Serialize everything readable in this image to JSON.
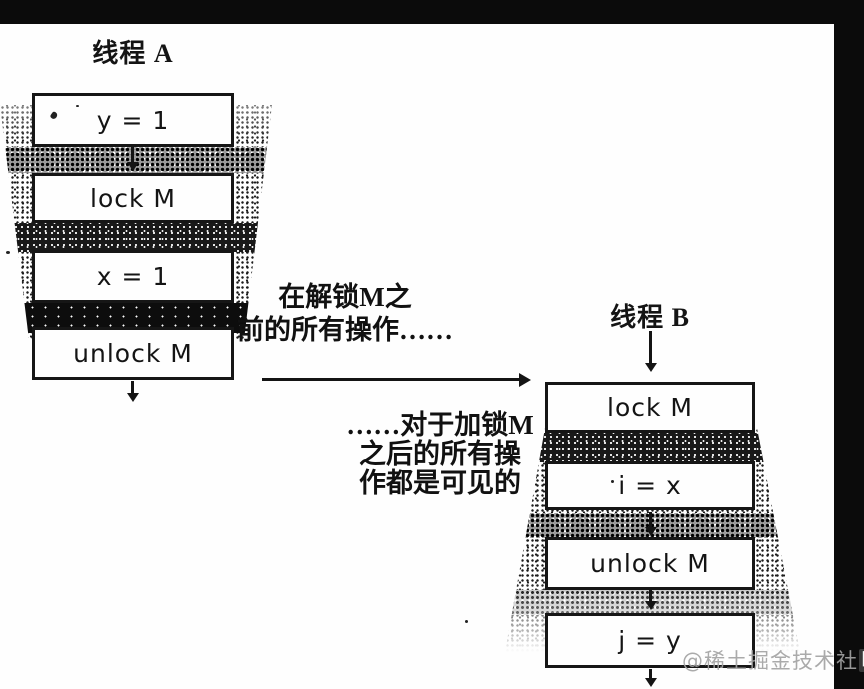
{
  "colors": {
    "ink": "#141414",
    "scan_black": "#0b0b0b",
    "watermark_gray": "#a3a3a3",
    "watermark_badge_bg": "#383838",
    "watermark_badge_fg": "#f7f7f7"
  },
  "diagram": {
    "thread_a": {
      "title": "线程 A",
      "boxes": [
        "y = 1",
        "lock M",
        "x = 1",
        "unlock M"
      ]
    },
    "thread_b": {
      "title": "线程 B",
      "boxes": [
        "lock M",
        "i = x",
        "unlock M",
        "j = y"
      ]
    },
    "annotations": {
      "before_unlock": {
        "line1": "在解锁M之",
        "line2": "前的所有操作……"
      },
      "after_lock": {
        "line1": "……对于加锁M",
        "line2": "之后的所有操",
        "line3": "作都是可见的"
      }
    }
  },
  "watermark": {
    "handle": "@稀土掘金技术社",
    "badge": "区"
  }
}
